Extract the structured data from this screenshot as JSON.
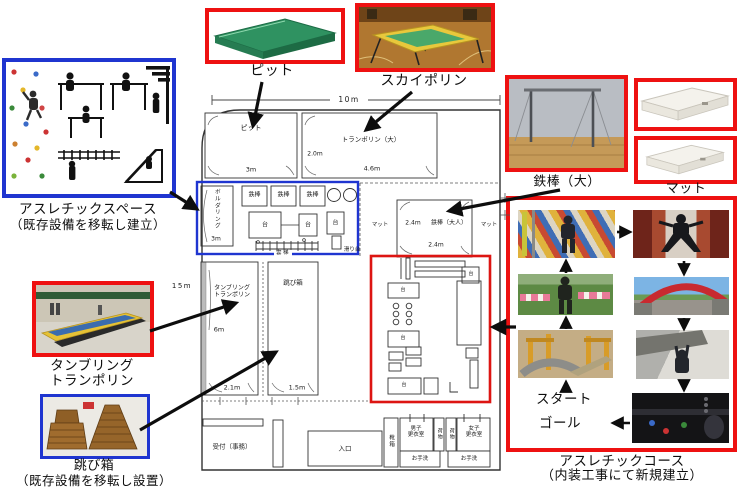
{
  "colors": {
    "accent_red": "#ee1111",
    "accent_blue": "#1f35d0"
  },
  "callouts": {
    "pit": {
      "label": "ピット"
    },
    "sky_trampoline": {
      "label": "スカイポリン"
    },
    "athletic_space": {
      "title": "アスレチックスペース",
      "subtitle": "（既存設備を移転し建立）"
    },
    "big_bar": {
      "label": "鉄棒（大）"
    },
    "mat": {
      "label": "マット"
    },
    "tumbling": {
      "label": "タンブリング\nトランポリン"
    },
    "vault": {
      "title": "跳び箱",
      "subtitle": "（既存設備を移転し設置）"
    },
    "course": {
      "title": "アスレチックコース",
      "subtitle": "（内装工事にて新規建立）",
      "start": "スタート",
      "goal": "ゴール"
    }
  },
  "plan": {
    "dims": {
      "width": "10m",
      "height": "15m"
    },
    "pit": {
      "label": "ピット",
      "width": "3m"
    },
    "trampoline": {
      "label": "トランポリン（大）",
      "height": "2.0m",
      "width": "4.6m"
    },
    "bouldering": {
      "label": "ボルダリング",
      "height": "3m"
    },
    "tetsubo": "鉄棒",
    "dai": "台",
    "untei": "雲梯",
    "suberidai": "滑り台",
    "tumbling_room": {
      "label": "タンブリング\nトランポリン",
      "height": "6m",
      "width": "2.1m"
    },
    "vault_room": {
      "label": "跳び箱",
      "width": "1.5m"
    },
    "adult_bar": {
      "label": "鉄棒（大人）",
      "mat": "マット",
      "w": "2.4m",
      "h": "2.4m"
    },
    "reception": "受付（事務）",
    "entrance": "入口",
    "shoes": "靴箱",
    "mens": "男子\n更衣室",
    "womens": "女子\n更衣室",
    "luggage": "荷物",
    "toilet": "お手洗"
  }
}
